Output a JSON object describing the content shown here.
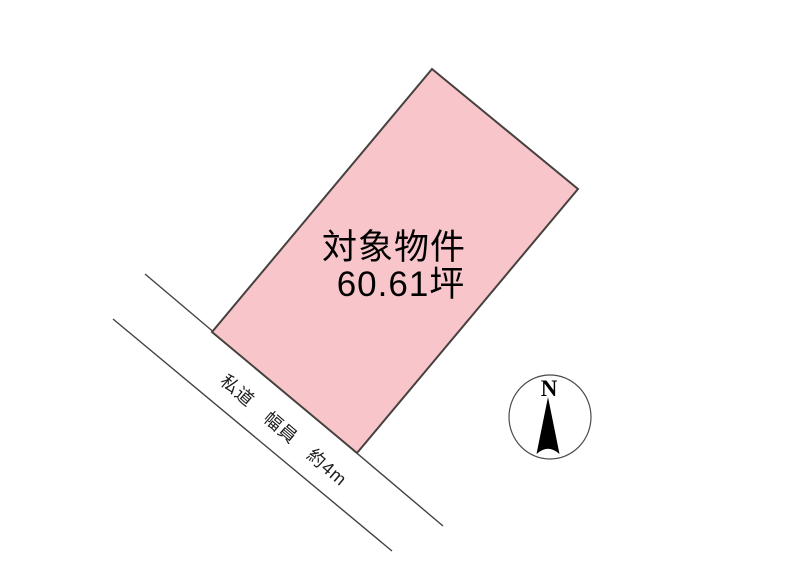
{
  "document": {
    "type": "land-plot-site-plan"
  },
  "colors": {
    "background": "#ffffff",
    "parcel_fill": "#f8c6ca",
    "parcel_stroke": "#46413f",
    "road_line": "#46413f",
    "text": "#000000"
  },
  "parcel": {
    "label_line1": "対象物件",
    "label_line2": "60.61坪"
  },
  "road": {
    "label": "私道　幅員　約4m"
  },
  "compass": {
    "north_label": "N"
  }
}
